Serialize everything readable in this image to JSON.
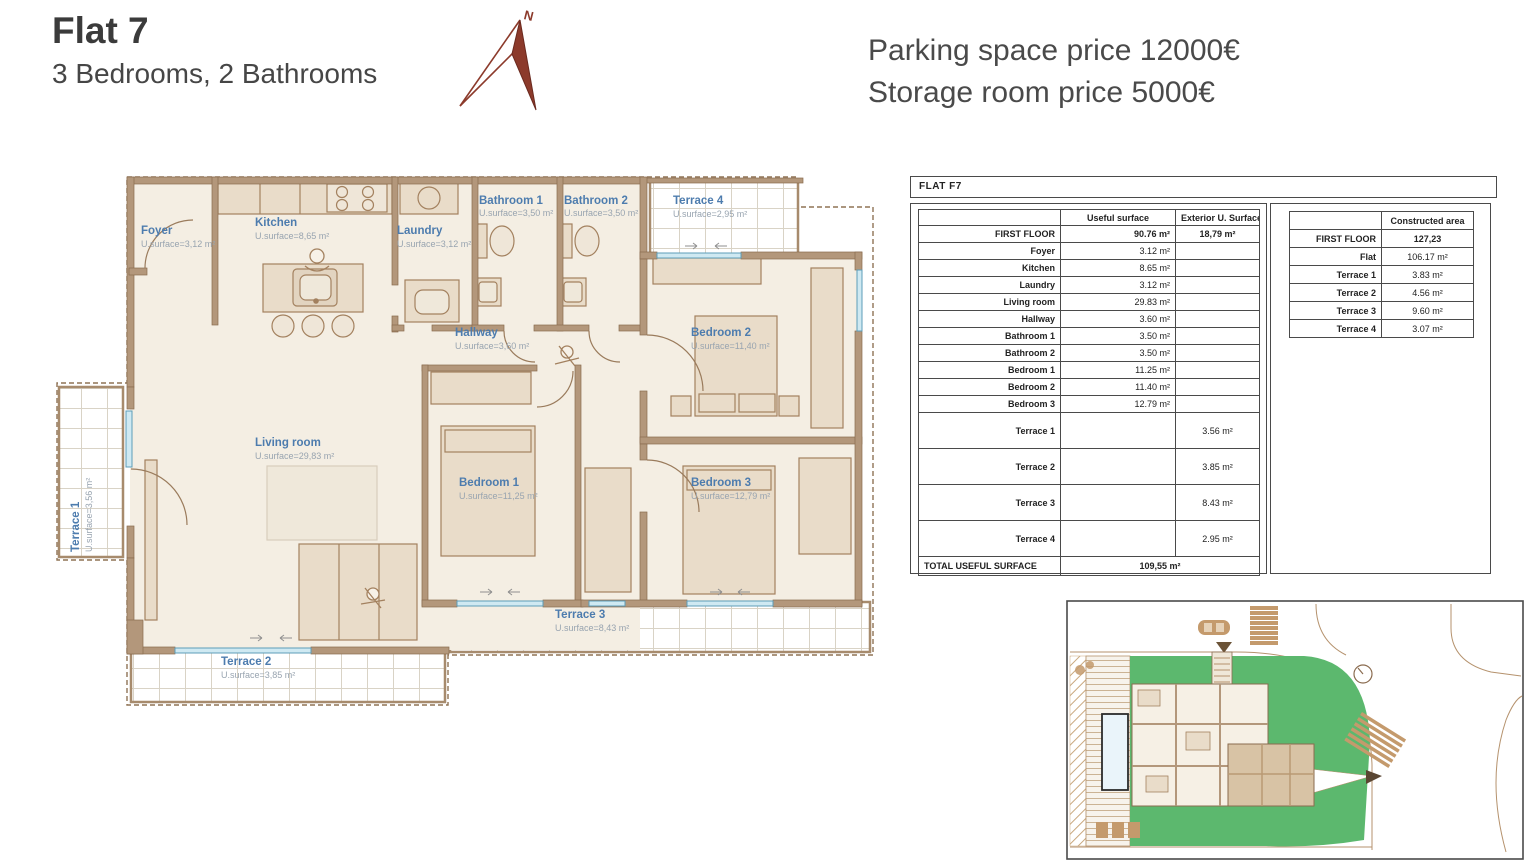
{
  "header": {
    "title": "Flat 7",
    "subtitle": "3 Bedrooms, 2 Bathrooms",
    "parking_line": "Parking space price 12000€",
    "storage_line": "Storage room price 5000€"
  },
  "compass": {
    "label": "N"
  },
  "floorplan": {
    "rooms": {
      "foyer": {
        "name": "Foyer",
        "surface": "U.surface=3,12 m²"
      },
      "kitchen": {
        "name": "Kitchen",
        "surface": "U.surface=8,65 m²"
      },
      "laundry": {
        "name": "Laundry",
        "surface": "U.surface=3,12 m²"
      },
      "bathroom1": {
        "name": "Bathroom 1",
        "surface": "U.surface=3,50 m²"
      },
      "bathroom2": {
        "name": "Bathroom 2",
        "surface": "U.surface=3,50 m²"
      },
      "terrace4": {
        "name": "Terrace 4",
        "surface": "U.surface=2,95 m²"
      },
      "bedroom2": {
        "name": "Bedroom 2",
        "surface": "U.surface=11,40 m²"
      },
      "hallway": {
        "name": "Hallway",
        "surface": "U.surface=3,60 m²"
      },
      "living": {
        "name": "Living room",
        "surface": "U.surface=29,83 m²"
      },
      "bedroom1": {
        "name": "Bedroom 1",
        "surface": "U.surface=11,25 m²"
      },
      "bedroom3": {
        "name": "Bedroom 3",
        "surface": "U.surface=12,79 m²"
      },
      "terrace3": {
        "name": "Terrace 3",
        "surface": "U.surface=8,43 m²"
      },
      "terrace2": {
        "name": "Terrace 2",
        "surface": "U.surface=3,85 m²"
      },
      "terrace1": {
        "name": "Terrace 1",
        "surface": "U.surface=3,56 m²"
      }
    }
  },
  "surface_table": {
    "title": "FLAT F7",
    "headers": {
      "useful": "Useful surface",
      "exterior": "Exterior U. Surface"
    },
    "rows": [
      {
        "label": "FIRST FLOOR",
        "useful": "90.76  m²",
        "exterior": "18,79  m²",
        "bold": true
      },
      {
        "label": "Foyer",
        "useful": "3.12  m²"
      },
      {
        "label": "Kitchen",
        "useful": "8.65  m²"
      },
      {
        "label": "Laundry",
        "useful": "3.12  m²"
      },
      {
        "label": "Living room",
        "useful": "29.83  m²"
      },
      {
        "label": "Hallway",
        "useful": "3.60  m²"
      },
      {
        "label": "Bathroom 1",
        "useful": "3.50  m²"
      },
      {
        "label": "Bathroom 2",
        "useful": "3.50  m²"
      },
      {
        "label": "Bedroom 1",
        "useful": "11.25  m²"
      },
      {
        "label": "Bedroom 2",
        "useful": "11.40  m²"
      },
      {
        "label": "Bedroom 3",
        "useful": "12.79  m²"
      }
    ],
    "terrace_rows": [
      {
        "label": "Terrace 1",
        "exterior": "3.56 m²"
      },
      {
        "label": "Terrace 2",
        "exterior": "3.85 m²"
      },
      {
        "label": "Terrace 3",
        "exterior": "8.43 m²"
      },
      {
        "label": "Terrace 4",
        "exterior": "2.95 m²"
      }
    ],
    "total": {
      "label": "TOTAL USEFUL SURFACE",
      "value": "109,55 m²"
    }
  },
  "constructed_table": {
    "header": "Constructed area",
    "rows": [
      {
        "label": "FIRST FLOOR",
        "value": "127,23",
        "bold": true
      },
      {
        "label": "Flat",
        "value": "106.17 m²"
      },
      {
        "label": "Terrace 1",
        "value": "3.83 m²"
      },
      {
        "label": "Terrace 2",
        "value": "4.56 m²"
      },
      {
        "label": "Terrace 3",
        "value": "9.60 m²"
      },
      {
        "label": "Terrace 4",
        "value": "3.07 m²"
      }
    ]
  },
  "colors": {
    "wall_brown": "#b3977b",
    "wall_outline": "#8a6b4f",
    "floor_cream": "#f4eee3",
    "furniture_fill": "#e9dcc9",
    "label_blue": "#4d7cae",
    "label_gray": "#98a4b0",
    "window_blue": "#79b7cf",
    "site_green": "#5cb86e",
    "compass_red": "#8c3a2b"
  }
}
